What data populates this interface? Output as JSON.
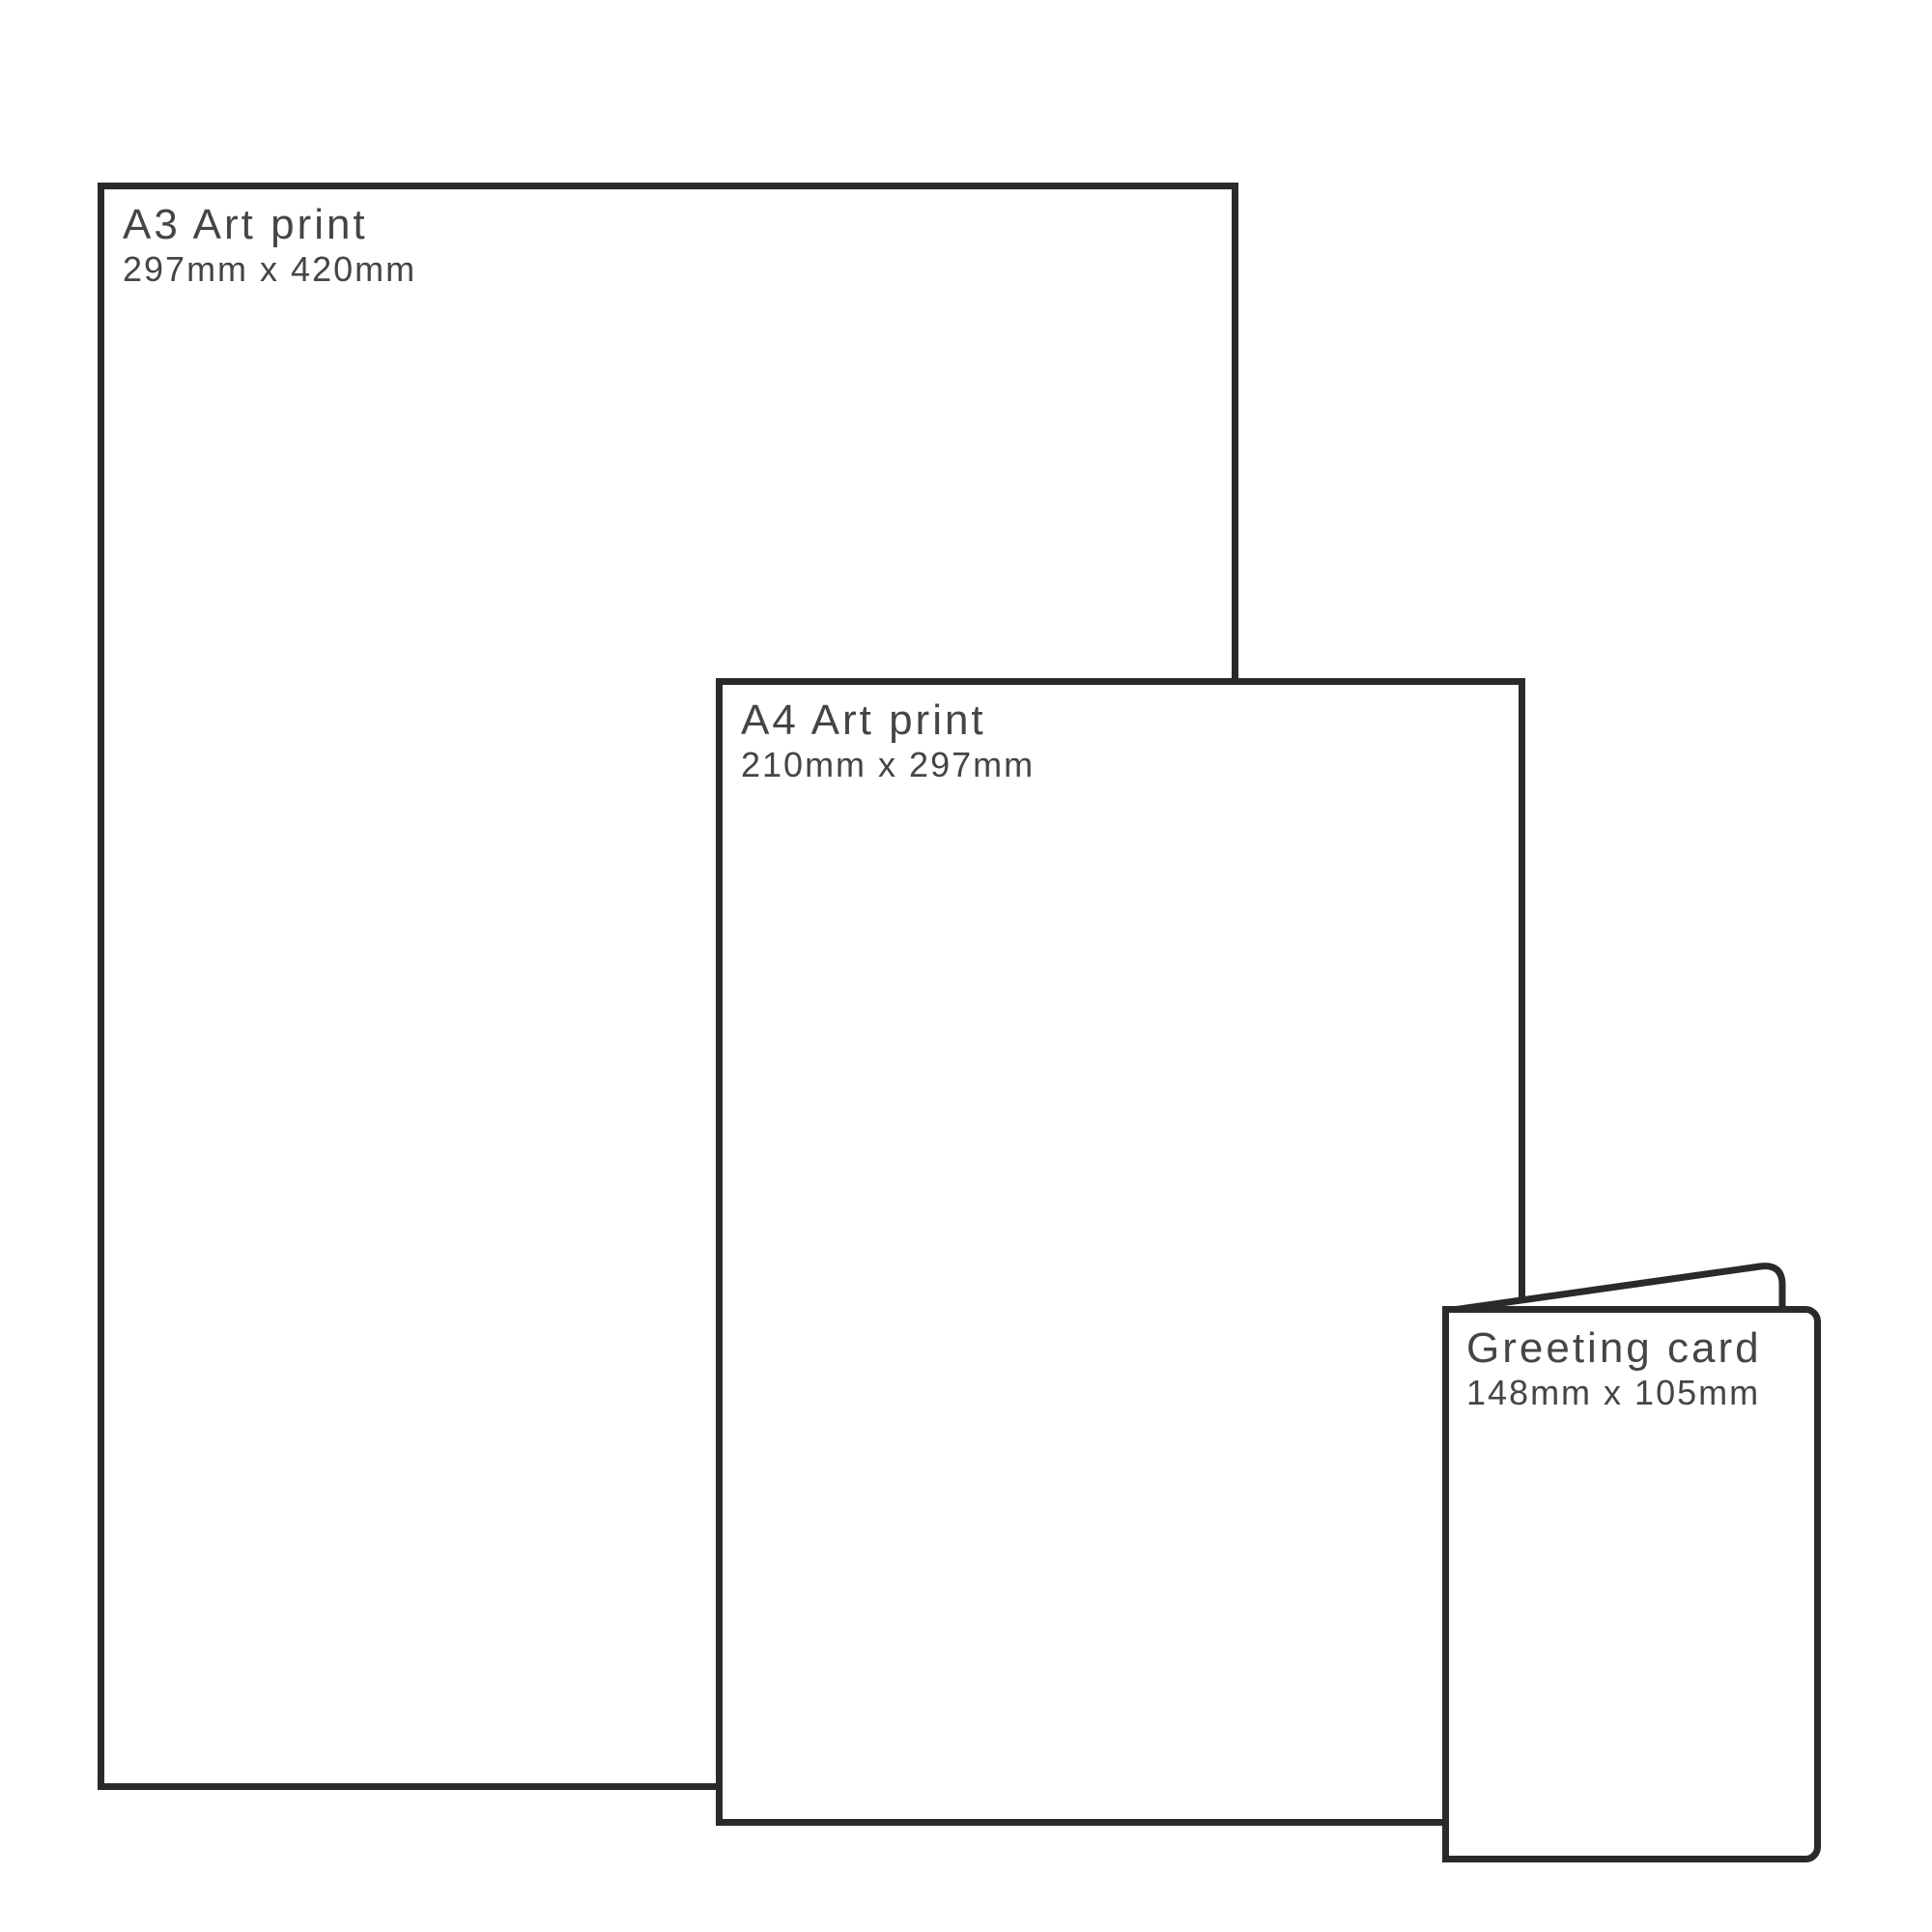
{
  "diagram": {
    "description": "Print size comparison diagram",
    "background_color": "#ffffff",
    "line_color": "#2a2a2a",
    "text_color": "#454545"
  },
  "items": [
    {
      "title": "A3 Art print",
      "dimensions": "297mm x 420mm"
    },
    {
      "title": "A4 Art print",
      "dimensions": "210mm x 297mm"
    },
    {
      "title": "Greeting card",
      "dimensions": "148mm x 105mm"
    }
  ]
}
